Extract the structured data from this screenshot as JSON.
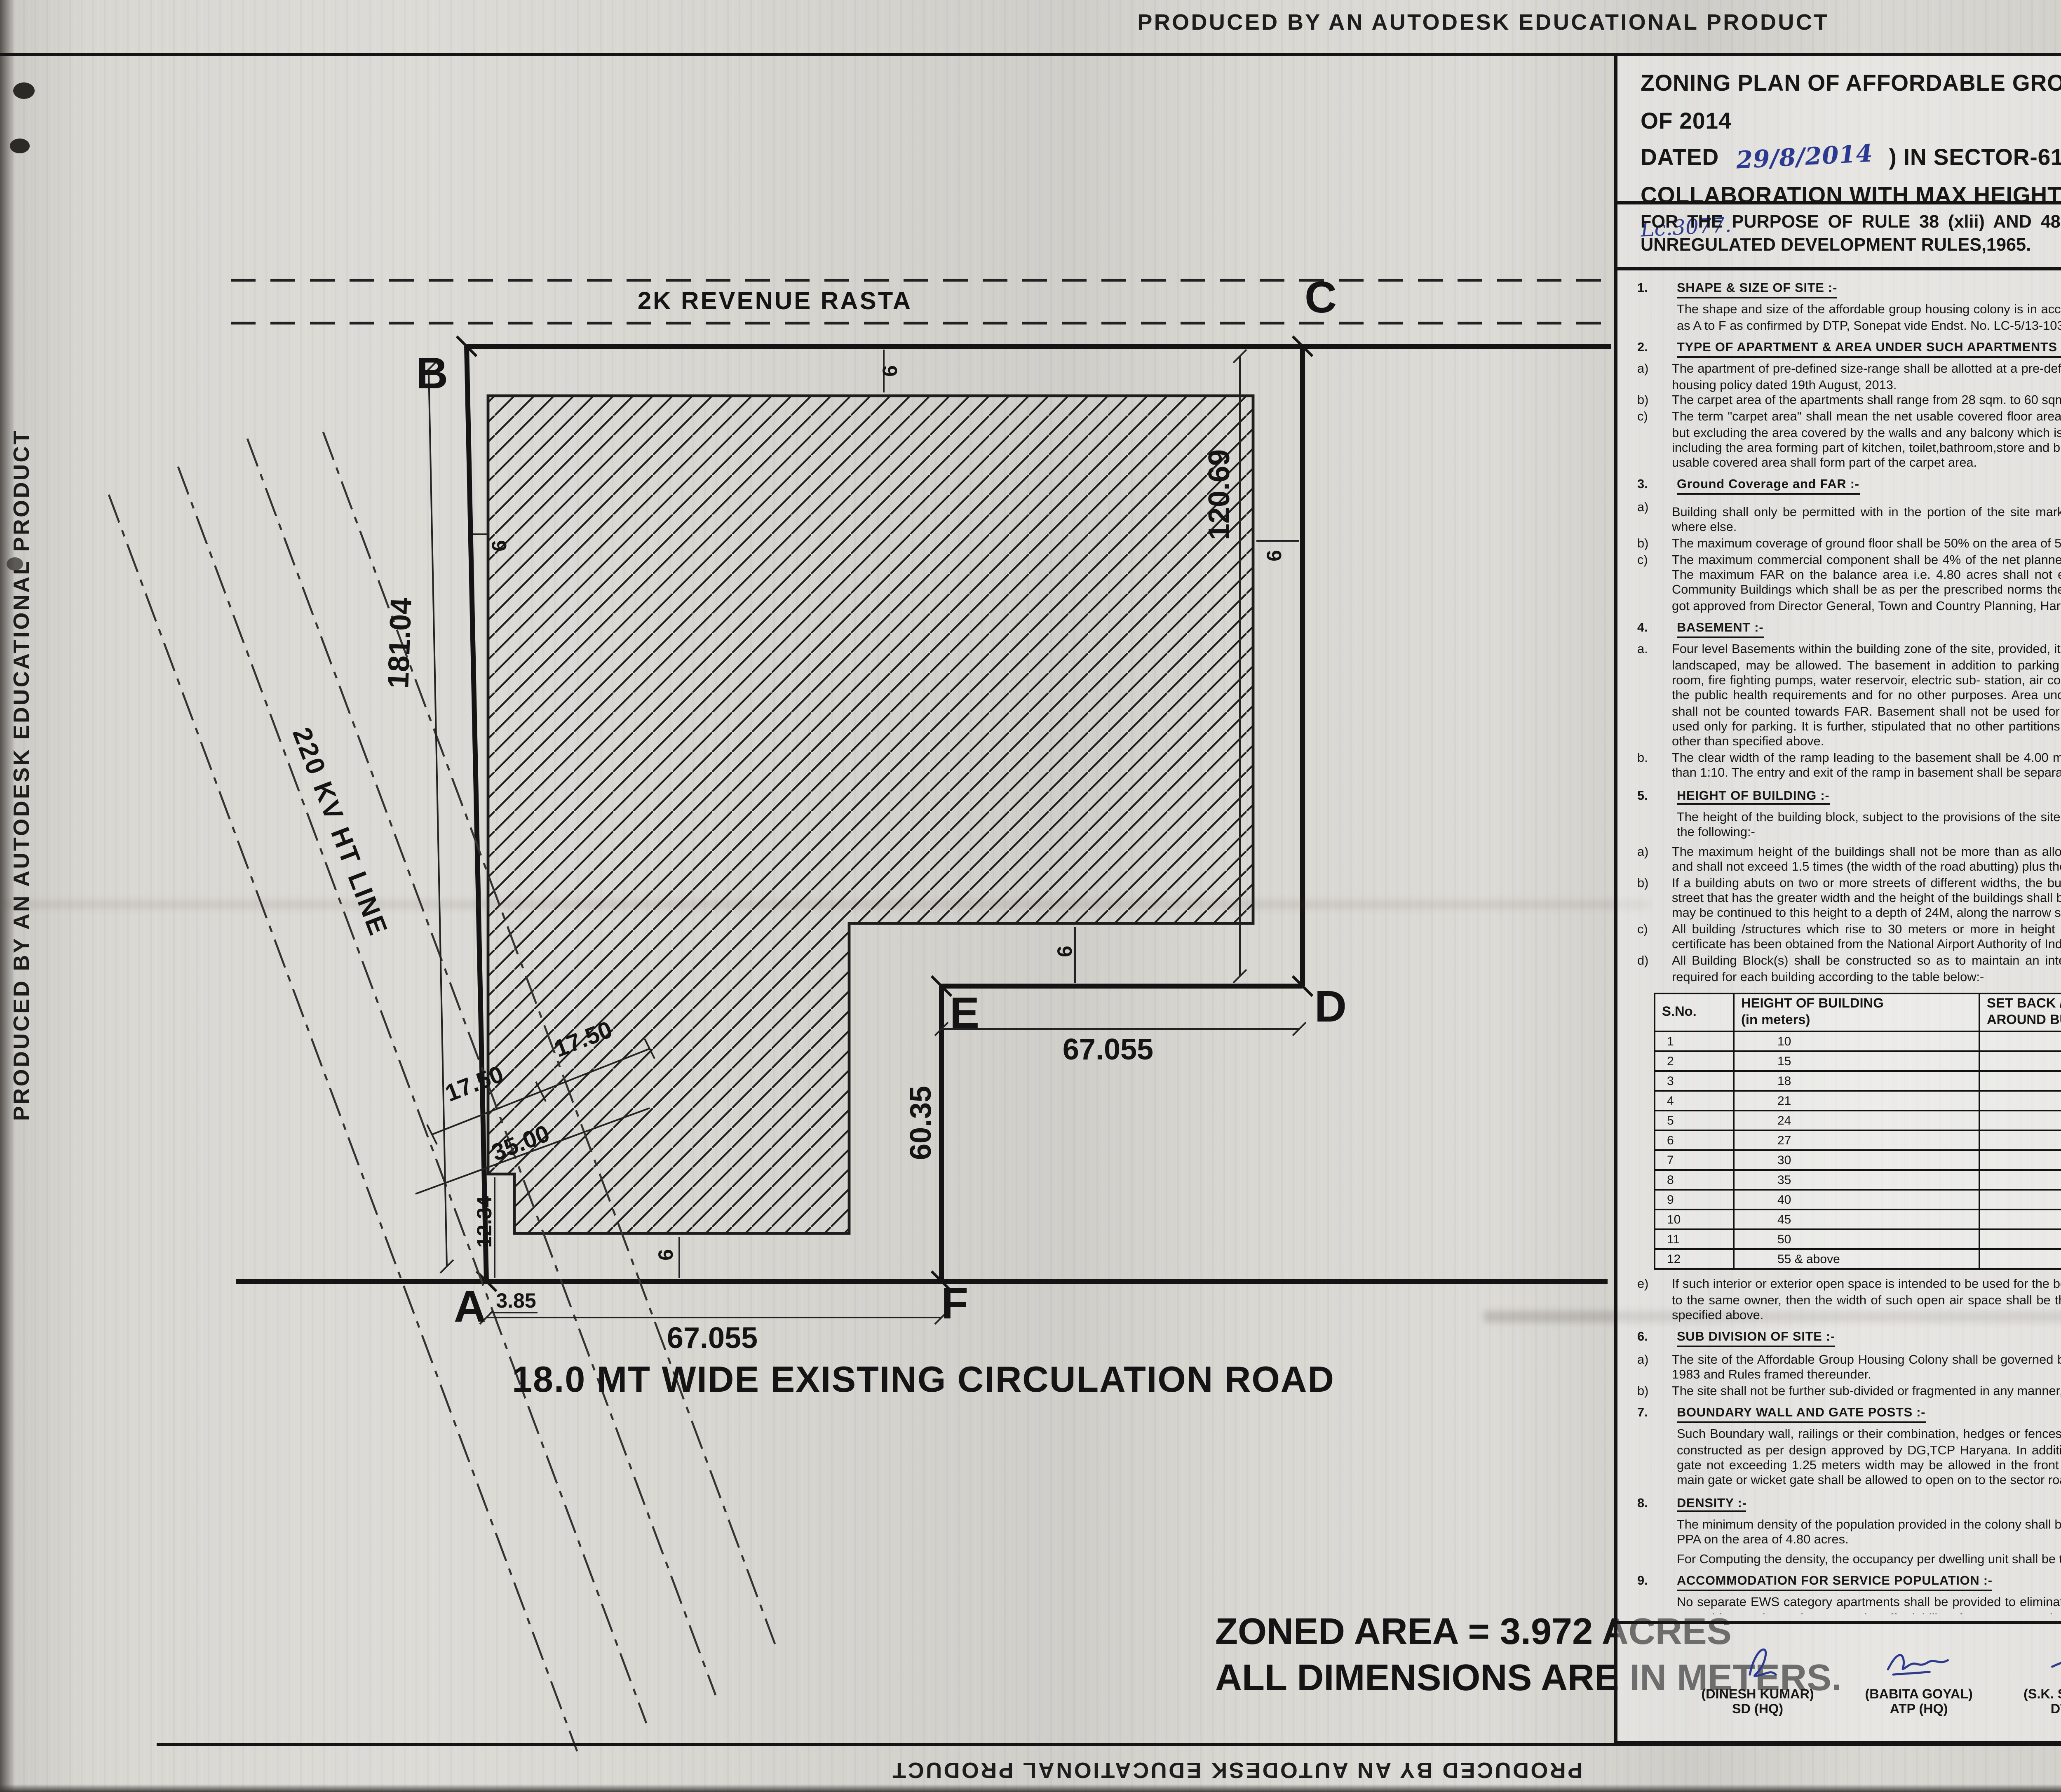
{
  "edge_banner": "PRODUCED BY AN AUTODESK EDUCATIONAL PRODUCT",
  "title": {
    "line1_pre": "ZONING PLAN OF AFFORDABLE GROUP HOUSING SCHEME MEASURING 5.0 ACRES (LICENCE NO.",
    "licence_no": "142",
    "line1_post": "OF 2014",
    "line2_pre": "DATED",
    "dated": "29/8/2014",
    "line2_post": ")  IN SECTOR-61, SONEPAT BEING DEVELOPED BY SH. RAM KISHAN AND OTHERS  IN",
    "line3": "COLLABORATION WITH MAX HEIGHTS PROMOTERS PVT. LTD.",
    "lc_note": "Lc.3077."
  },
  "purpose": "FOR THE PURPOSE OF RULE 38 (xlii) AND 48 (2) OF THE PUNJAB SCHEDULED ROADS  AND CONTROLLED AREAS RESTRICTION OF UNREGULATED DEVELOPMENT RULES,1965.",
  "left_sections": [
    {
      "num": "1.",
      "heading": "SHAPE & SIZE OF SITE :-",
      "paras": [
        "The shape and size of the affordable group housing colony is in accordance with the demarcation plan shown as A to  F  as confirmed by DTP, Sonepat vide Endst. No. LC-5/13-103 dated 26.08.2014."
      ]
    },
    {
      "num": "2.",
      "heading": "TYPE OF APARTMENT & AREA UNDER SUCH APARTMENTS :-",
      "items": [
        {
          "label": "a)",
          "text": "The apartment of pre-defined size-range shall be allotted at a pre-defined rate to ensure provision of affordable housing policy dated 19th August, 2013."
        },
        {
          "label": "b)",
          "text": "The carpet area of the apartments shall  range from 28 sqm. to 60 sqm. in size."
        },
        {
          "label": "c)",
          "text": "The term \"carpet area\" shall mean the net usable covered floor area bound within the walls of the apartments but excluding the area covered by the walls and any  balcony which is approved free-of-FAR (only balcony), but including the area forming part of kitchen, toilet,bathroom,store and built-in cupboard/almirah/shelf, which being usable covered area shall form part of the carpet area."
        }
      ]
    },
    {
      "num": "3.",
      "heading": "Ground Coverage and FAR :-",
      "items": [
        {
          "label": "a)",
          "swatch": true,
          "text_a": "Building shall only be permitted with in the portion of the site marked as",
          "text_b": "buildable  zone and no where else."
        },
        {
          "label": "b)",
          "text": "The maximum coverage of ground floor shall be 50%  on the area of  5.0 acres."
        },
        {
          "label": "c)",
          "text": "The maximum commercial component shall be 4% of the net planned area i.e. 0.20 acre with an FAR of 175. The maximum FAR on the balance area i.e. 4.80 acres shall not exceed 225. However it shall not include Community Buildings which shall be as per the prescribed norms the Building Plans of which shall have to be got approved from Director General, Town and Country Planning, Haryana."
        }
      ]
    },
    {
      "num": "4.",
      "heading": "BASEMENT :-",
      "items": [
        {
          "label": "a.",
          "text": "Four level Basements within the building zone of the site, provided, it is flushed with the ground and is properly landscaped, may be allowed. The basement in addition to parking could be utilized for generator room, lift room, fire fighting pumps, water reservoir, electric sub- station, air conditioning plants and toilets, if they satisfy the public health requirements and for no other purposes. Area under stilts (only for parking) and basement shall not be counted towards FAR. Basement shall not be used for storage/commercial purposes but will be used only for parking. It is further, stipulated that no other partitions of basement will be permissible for uses other than specified above."
        },
        {
          "label": "b.",
          "text": "The clear width of the ramp leading to the basement shall be 4.00 meters with an adequate slope not steeper than 1:10. The entry and exit of the ramp in basement shall be separate preferably at opposite ends"
        }
      ]
    },
    {
      "num": "5.",
      "heading": "HEIGHT OF BUILDING :-",
      "intro": "The height of the building block, subject to the provisions of the site coverage and FAR, shall be governed by the following:-",
      "items": [
        {
          "label": "a)",
          "text": "The maximum height of the buildings shall not be more than as allowed by National Airport Authority of India and shall not exceed 1.5 times (the width of the road abutting) plus the front  open space."
        },
        {
          "label": "b)",
          "text": "If a building abuts on two or more streets of different widths, the buildings shall be deemed to face  upon the street that has the greater width and the height of the buildings shall be regulated by the width of that street and may be continued to this height to a depth of 24M, along the narrow street."
        },
        {
          "label": "c)",
          "text": "All building /structures which rise to 30 meters or more in height shall be constructed only if no objection certificate has been obtained from the National Airport Authority of India."
        },
        {
          "label": "d)",
          "text": "All Building Block(s) shall be constructed so as to maintain an interse distance not less then the set back required for each building according to the table below:-"
        }
      ],
      "table": {
        "headers": [
          "S.No.",
          "HEIGHT OF BUILDING\n(in meters)",
          "SET BACK / OPEN SPACE TO BE LEFT\nAROUND BUILDINGS. (in meters)"
        ],
        "rows": [
          [
            "1",
            "10",
            "3"
          ],
          [
            "2",
            "15",
            "5"
          ],
          [
            "3",
            "18",
            "6"
          ],
          [
            "4",
            "21",
            "7"
          ],
          [
            "5",
            "24",
            "8"
          ],
          [
            "6",
            "27",
            "9"
          ],
          [
            "7",
            "30",
            "10"
          ],
          [
            "8",
            "35",
            "11"
          ],
          [
            "9",
            "40",
            "12"
          ],
          [
            "10",
            "45",
            "13"
          ],
          [
            "11",
            "50",
            "14"
          ],
          [
            "12",
            "55 & above",
            "16"
          ]
        ]
      },
      "items2": [
        {
          "label": "e)",
          "text": "If such interior or exterior open space is intended to be used for the benefit of more than one building belonging to the same owner, then the width of such open air space  shall be the one specified for the tallest building as specified above."
        }
      ]
    },
    {
      "num": "6.",
      "heading": "SUB DIVISION OF SITE :-",
      "items": [
        {
          "label": "a)",
          "text": "The site of the Affordable Group Housing Colony shall be governed by the Haryana Apartment Ownership Act-1983 and Rules framed thereunder."
        },
        {
          "label": "b)",
          "text": "The site shall not be further sub-divided or fragmented in any  manner, whatsoever."
        }
      ]
    },
    {
      "num": "7.",
      "heading": "BOUNDARY WALL AND GATE POSTS :-",
      "paras": [
        "Such Boundary wall, railings or their combination, hedges or fences along with gates and gate posts shall be constructed as per design approved by DG,TCP Haryana. In addition to the gate/gates an additional wicket gate not exceeding 1.25 meters width may be allowed in the front and side boundary wall provided that no main gate or wicket gate shall be allowed to open on to the sector road/ public open space."
      ]
    },
    {
      "num": "8.",
      "heading": "DENSITY :-",
      "paras": [
        "The minimum density of the population provided in the colony shall be 850 PPA and the maximum shall be 900 PPA on the area of 4.80 acres.",
        "For Computing the density, the occupancy per dwelling unit shall be taken as five persons."
      ]
    },
    {
      "num": "9.",
      "heading": "ACCOMMODATION FOR SERVICE POPULATION  :-",
      "paras": [
        "No separate EWS category apartments shall be provided to eliminate any cross subsidy component and thus to avoid any adverse impact on the affordability of apartment made available under affordable housing policy dated 19th August, 2013."
      ]
    }
  ],
  "right_sections": [
    {
      "num": "10.",
      "heading": "PARKING :-",
      "items": [
        {
          "label": "a.",
          "text": "The parking space shall be provided at the rate of half equivalent car space ( ECS) for each dwelling unit."
        },
        {
          "label": "b.",
          "text": "Only one two-wheeler parking site shall be earmarked for each flat, which shall be allotted only to the flat-owners. The parking bay of two-wheelers shall be 0.8 x 2.5 m."
        },
        {
          "label": "c.",
          "text": "No car parking shall be allotted to any apartment owner in such projects."
        },
        {
          "label": "d.",
          "text": "The balance available parking space, if any, beyond the allocated two-wheeler parking sites, can be earmarked as free-visitor-car-parking space"
        },
        {
          "label": "e.",
          "text": "The area for parking per car shall be as under :-",
          "rows": [
            {
              "label": "a)",
              "name": "Basement.",
              "value": "35 sqm."
            },
            {
              "label": "b)",
              "name": "Stilts.",
              "value": "30 sqm."
            },
            {
              "label": "c)",
              "name": "Open.",
              "value": "25 sqm."
            }
          ]
        }
      ]
    },
    {
      "num": "11.",
      "heading": "LIFTS AND RAMPS :-",
      "items": [
        {
          "label": "i.",
          "text": "In building having more than four storeys, lift with 100% standby generators alongwith automatic switchover is mandatory alongwith staircase of requisite width and number. At least one lift  with minimum size of 1.80 M X 3.00 M shall be provided."
        },
        {
          "label": "ii.",
          "text": "In building upto four storeys, if lifts with 100% standby generators  along with automatic switchover are not provided then ramps conforming to the requirement of clause D-3 of Annexure-D of Part 3 of National building Code-2005 shall be provided."
        }
      ]
    },
    {
      "num": "12.",
      "heading": "OPEN SPACES  :-",
      "paras": [
        "While all the open spaces including those between the blocks and wings of Buildings shall be developed, equipped and landscaped according to the plan approved by DG,TCP, Haryana. At least 15% of the net planned area shall be developed as organized open space i.e. tot lots and play ground."
      ]
    },
    {
      "num": "13.",
      "heading": "APPROVAL OF BUILDING PLANS :-",
      "paras": [
        "The building plans of the buildings to be constructed at site shall have to be got approved from the DG,TCP, Haryana (under section 8 (2) of the Punjab Scheduled Roads Controlled Areas, Restriction of Unregulated Development Act No. 41 of 1963) before starting the construction."
      ]
    },
    {
      "num": "14.",
      "heading": "BUILDING BYE- LAWS :-",
      "paras": [
        "The construction of the building/buildings shall be governed by the building rules provided in part  VII of the Punjab Scheduled Roads Controlled Areas, Restriction of Unregulated Development Rules, 1965 and Indian Standard Code No. 4963-1987 regarding provisions for Physically Handicapped Persons. The owner shall also follow the provisions of Section 46 of The Persons With Disabilities (Equal Opportunities, Protection of Rights and Full Participation) Act, 1995 which includes construction of ramps in public buildings, adaption of toilets for wheel chair user, Braille symbols and auditory signals in elevators or lifts and other relevant measures. On  the points where such rules are silent and stipulate no condition or norm, the model building byelaw issued by the Indian Standard, and as given in the National Building Code of India shall be followed as may be approved by DG,TCP, Haryana."
      ]
    },
    {
      "num": "15.",
      "heading": "PROVISION OF COMMUNITY BUILDINGS :-",
      "intro": "The coloniser shall be required to provide the following community sites in the project , which shall form part of the common areas and facilities as defined under the Haryana Apartment Ownership Act-1983.",
      "items": [
        {
          "label": "a.",
          "text": "One built-up community Hall of not less than 2000 sft area."
        },
        {
          "label": "b.",
          "text": "One built-up Anganwadi-cum-creche of not less than 2000 sft area."
        }
      ]
    },
    {
      "num": "16.",
      "heading": "APPROACH TO SITE :-",
      "paras": [
        "The vehicular approach to the site and parking lots shall be planned and provided giving due consideration to the junctions off and the junctions with the surrounding road to the satisfaction of the DG,TCP, Haryana."
      ]
    },
    {
      "num": "17.",
      "heading": "FIRE SAFETY MEASURES :",
      "items": [
        {
          "label": "a)",
          "text": "The owner will ensure the provision of proper fire safety measures in the multi storeyed buildings conforming to the provisions of Punjab Scheduled Roads Controlled Areas, Restriction of Unregulated Development Rules, 1965 / National Building Code of India and the same should be got certified from the competent authority."
        },
        {
          "label": "b)",
          "text": "Electric Sub Station/generator room if provided should be on solid ground near DG/LT. Control panel on ground floor or in upper basement and it should be located on outer periphery of the building, the same should be got approved from the competent authority."
        },
        {
          "label": "c)",
          "text": "To ensure fire fighting scheme shall be got approved from the Director, Urban Local Bodies, Haryana or any person authorized by the Director, Urban Local Bodies, Haryana. These approval shall be obtained prior to starting the construction work at site."
        }
      ]
    },
    {
      "num": "18.",
      "heading": "SOLAR WATER HEATING SYSTEM  :-",
      "paras": [
        "The provision of solar water heating system shall be as per norms specified by HAREDA and shall be made operational in each building blocks (where hot water is required) before applying for an occupation certificate."
      ]
    },
    {
      "num": "19.",
      "heading": "RAIN WATER HARVESTING SYSTEM  :-",
      "paras": [
        "That the rain water harvesting system shall be provided as per Central Ground Water Authority norms/Haryana Govt. notification as applicable."
      ]
    },
    {
      "num": "20.",
      "heading": null,
      "paras": [
        "The owner shall obtain the clearance/NOC as per the provisions of the Notification No. S.O. 1533 (E) Dated 14.09.2006 issued by Ministry of Environment and Forest, Government of India before starting the construction/ execution of development works at site."
      ]
    },
    {
      "num": "21.",
      "heading": null,
      "paras": [
        "That the applicant shall use only Compact Fluorescent Lamps fitting for internal lighting as well as Campus lighting."
      ]
    },
    {
      "num": "22,",
      "heading": null,
      "paras": [
        "That no separate zoning plan is approved for community site/sites earmarked within group housing scheme. The community building/buildings shall be constructed by the coloniser/owner as per provisions of the Haryana Development and Regulation of Urban Areas (Amendment and validation) Act No. 4 of 2012, failing which the said site shall vest with the Government."
      ]
    },
    {
      "num": "23.",
      "heading": null,
      "paras": [
        "The coloniser shall convey the \"Ultimate Power Load Requirement\" of the project to the concerned power utility, with a copy to the Director, within two months period from the date of grant of licence to enable provision of site in your land for Transformers/Switching Station/Electric Sub-Stations as  per the norms prescribed by the power utility at the time of approval of building plans of the projects."
      ]
    }
  ],
  "drg": {
    "label1": "DRG. No. DG,TCP",
    "value1": "4882.",
    "label2": "DATED",
    "value2": "29/8/2014."
  },
  "signatures": [
    {
      "name": "(DINESH KUMAR)",
      "title": "SD (HQ)",
      "ink": "blue",
      "note": ""
    },
    {
      "name": "(BABITA GOYAL)",
      "title": "ATP (HQ)",
      "ink": "blue",
      "note": ""
    },
    {
      "name": "(S.K. SEHRAWAT)",
      "title": "DTP (HQ)",
      "ink": "blue",
      "note": ""
    },
    {
      "name": "(JASWANT SINGH",
      "title": "STP(M) HQ",
      "ink": "blue",
      "note": ""
    },
    {
      "name": "(J. S. REDHU)",
      "title": "CTP (HR)",
      "ink": "blue",
      "note": ""
    },
    {
      "name": "(ANURAG RASTOGI, IAS)",
      "title": "DG,TCP (HR)",
      "ink": "green",
      "note": "C/s"
    }
  ],
  "plan": {
    "rasta": "2K REVENUE  RASTA",
    "road": "18.0 MT WIDE EXISTING CIRCULATION ROAD",
    "ht_line": "220 KV HT LINE",
    "zoned_area_line1": "ZONED AREA =  3.972 ACRES",
    "zoned_area_line2": "ALL DIMENSIONS ARE IN METERS.",
    "corners": {
      "a": "A",
      "b": "B",
      "c": "C",
      "d": "D",
      "e": "E",
      "f": "F"
    },
    "dims": {
      "left_edge": "181.04",
      "right_edge": "120.69",
      "notch_width": "67.055",
      "notch_height": "60.35",
      "bottom_width": "67.055",
      "ht1": "17.50",
      "ht2": "17.50",
      "ht3": "35.00",
      "step_v": "12.34",
      "step_h": "3.85",
      "setback": "6"
    }
  }
}
